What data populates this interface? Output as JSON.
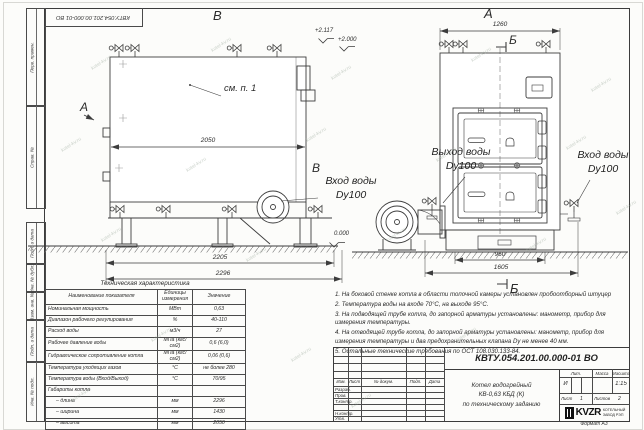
{
  "watermark": {
    "text": "kotel-kv.ru"
  },
  "sheet": {
    "top_stamp": "КВТУ.054.201.00.000-01 ВО",
    "margin_top_cells": [
      "Перв. примен.",
      "Справ. №"
    ],
    "margin_bottom_cells": [
      "Подп. и дата",
      "Инв. № дубл.",
      "Взам. инв. №",
      "Подп. и дата",
      "Инв. № подл."
    ],
    "format_label": "Формат А3"
  },
  "drawing": {
    "view_left": {
      "view_label": "В",
      "section_a": "А",
      "side_label": "В",
      "callout": "см. п. 1",
      "dim_mid": "2050",
      "dim_b1": "2205",
      "dim_b2": "2296",
      "inlet_line1": "Вход воды",
      "inlet_line2": "Dy100"
    },
    "view_right": {
      "view_label": "А",
      "dim_top": "1260",
      "section_b_top": "Б",
      "section_b_bottom": "Б",
      "outlet_line1": "Выход воды",
      "outlet_line2": "Dy100",
      "inlet_line1": "Вход воды",
      "inlet_line2": "Dy100",
      "dim_b1": "960",
      "dim_b2": "1605"
    },
    "elevations": {
      "top1": "+2.117",
      "top2": "+2.000",
      "zero": "0.000"
    }
  },
  "tech_table": {
    "title": "Техническая характеристика",
    "col_name": "Наименование показателя",
    "col_units": "Единицы измерения",
    "col_value": "Значение",
    "rows": [
      [
        "Номинальная мощность",
        "МВт",
        "0,63"
      ],
      [
        "Диапазон рабочего регулирования",
        "%",
        "40-110"
      ],
      [
        "Расход воды",
        "м3/ч",
        "27"
      ],
      [
        "Рабочее давление воды",
        "МПа (кгс/см2)",
        "0,6 (6,0)"
      ],
      [
        "Гидравлическое сопротивление котла",
        "МПа (кгс/см2)",
        "0,06 (0,6)"
      ],
      [
        "Температура уходящих газов",
        "°С",
        "не более 280"
      ],
      [
        "Температура воды (Вход/Выход)",
        "°С",
        "70/95"
      ],
      [
        "Габариты котла",
        "",
        ""
      ],
      [
        "– длина",
        "мм",
        "2296"
      ],
      [
        "– ширина",
        "мм",
        "1430"
      ],
      [
        "– высота",
        "мм",
        "2050"
      ]
    ]
  },
  "notes": {
    "items": [
      "1. На боковой стенке котла в области топочной камеры установлен пробоотборный штуцер",
      "2. Температура воды на входе 70°С, на выходе 95°С.",
      "3. На подводящей трубе котла, до запорной арматуры установлены: манометр, прибор для измерения температуры.",
      "4. На отводящей трубе котла, до запорной арматуры установлены: манометр, прибор для измерения температуры и два предохранительных клапана Dу не менее 40 мм.",
      "5. Остальные технические требования по ОСТ 108.030.133-84."
    ]
  },
  "title_block": {
    "doc_number": "КВТУ.054.201.00.000-01 ВО",
    "product_line1": "Котел водогрейный",
    "product_line2": "КВ-0,63 КБД (К)",
    "product_line3": "по техническому заданию",
    "header_cols": [
      "Изм.",
      "Лист",
      "№ докум.",
      "Подп.",
      "Дата"
    ],
    "row_labels": [
      "Разраб.",
      "Пров.",
      "Т.контр.",
      "",
      "Н.контр.",
      "Утв."
    ],
    "lit_label": "Лит.",
    "mass_label": "Масса",
    "scale_label": "Масштаб",
    "lit_value": "И",
    "scale_value": "1:15",
    "sheet_label": "Лист",
    "sheet_value": "1",
    "sheets_label": "Листов",
    "sheets_value": "2",
    "logo_text": "KVZR",
    "logo_sub1": "КОТЕЛЬНЫЙ",
    "logo_sub2": "ЗАВОД РЭП"
  }
}
